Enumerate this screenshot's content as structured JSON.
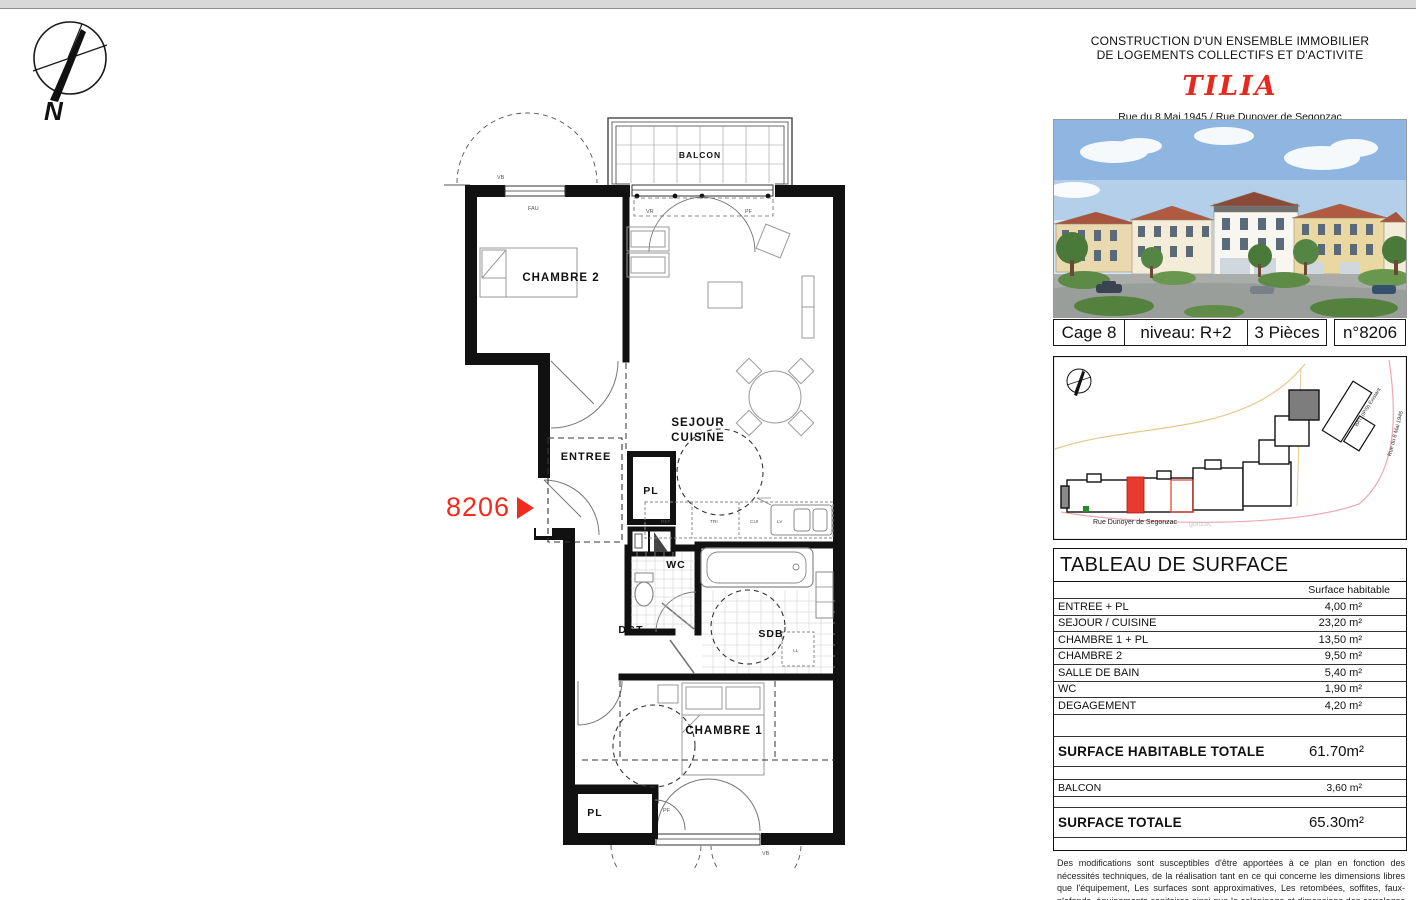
{
  "header": {
    "line1": "CONSTRUCTION D'UN ENSEMBLE IMMOBILIER",
    "line2": "DE LOGEMENTS COLLECTIFS ET D'ACTIVITE",
    "project": "TILIA",
    "address1": "Rue du 8 Mai 1945 / Rue Dunoyer de Segonzac",
    "address2": "94510 La QUEUE-EN-BRIE"
  },
  "info_bar": {
    "cage": "Cage 8",
    "niveau": "niveau: R+2",
    "pieces": "3 Pièces",
    "numero": "n°8206"
  },
  "site_plan": {
    "street_bottom": "Rue Dunoyer de Segonzac",
    "street_bottom_echo": "gonzac",
    "street_right": "Rue du 8 Mai 1945",
    "existing_building": "BAT. (IP/9) Existant"
  },
  "surface_table": {
    "title": "TABLEAU DE SURFACE",
    "column_header": "Surface habitable",
    "rows": [
      {
        "label": "ENTREE + PL",
        "value": "4,00 m²"
      },
      {
        "label": "SEJOUR / CUISINE",
        "value": "23,20 m²"
      },
      {
        "label": "CHAMBRE 1 + PL",
        "value": "13,50 m²"
      },
      {
        "label": "CHAMBRE 2",
        "value": "9,50 m²"
      },
      {
        "label": "SALLE DE BAIN",
        "value": "5,40 m²"
      },
      {
        "label": "WC",
        "value": "1,90 m²"
      },
      {
        "label": "DEGAGEMENT",
        "value": "4,20 m²"
      }
    ],
    "subtotal": {
      "label": "SURFACE HABITABLE TOTALE",
      "value": "61.70m²"
    },
    "balcon": {
      "label": "BALCON",
      "value": "3,60 m²"
    },
    "total": {
      "label": "SURFACE TOTALE",
      "value": "65.30m²"
    }
  },
  "disclaimer": "Des modifications sont susceptibles d'être apportées à ce plan en fonction des nécessités techniques, de la réalisation tant en ce qui concerne les dimensions libres que l'équipement, Les surfaces sont approximatives, Les retombées, soffites, faux-plafonds, équipements sanitaires ainsi que le calepinage et dimensions des carrelages sont figurés à titre indicatif, et peuvent subir des modifications pour impératif technique. Mobilier à titre indicatif, les meubles et les appareils ménagers ne sont pas fournis.",
  "plan": {
    "unit_number": "8206",
    "north_label": "N",
    "rooms": {
      "balcon": "BALCON",
      "chambre2": "CHAMBRE 2",
      "sejour_line1": "SEJOUR",
      "sejour_line2": "CUISINE",
      "entree": "ENTREE",
      "pl_entree": "PL",
      "wc": "WC",
      "dgt": "DGT",
      "sdb": "SDB",
      "chambre1": "CHAMBRE 1",
      "pl_chambre1": "PL"
    },
    "fixtures": {
      "ref": "REF",
      "tri": "TRI",
      "cui": "CUI",
      "lv": "LV",
      "ll": "LL"
    },
    "openings": {
      "vb_top": "VB",
      "fau": "FAU",
      "vr": "VR",
      "pf": "PF",
      "pf_bottom": "PF",
      "vb_bottom": "VB"
    }
  },
  "colors": {
    "accent_red": "#e8281e",
    "marker_red": "#f32a1e",
    "site_highlight_red": "#e83a2e",
    "site_boundary_orange": "#e6c88c",
    "site_boundary_pink": "#f0a8b0",
    "wall_black": "#111111"
  }
}
